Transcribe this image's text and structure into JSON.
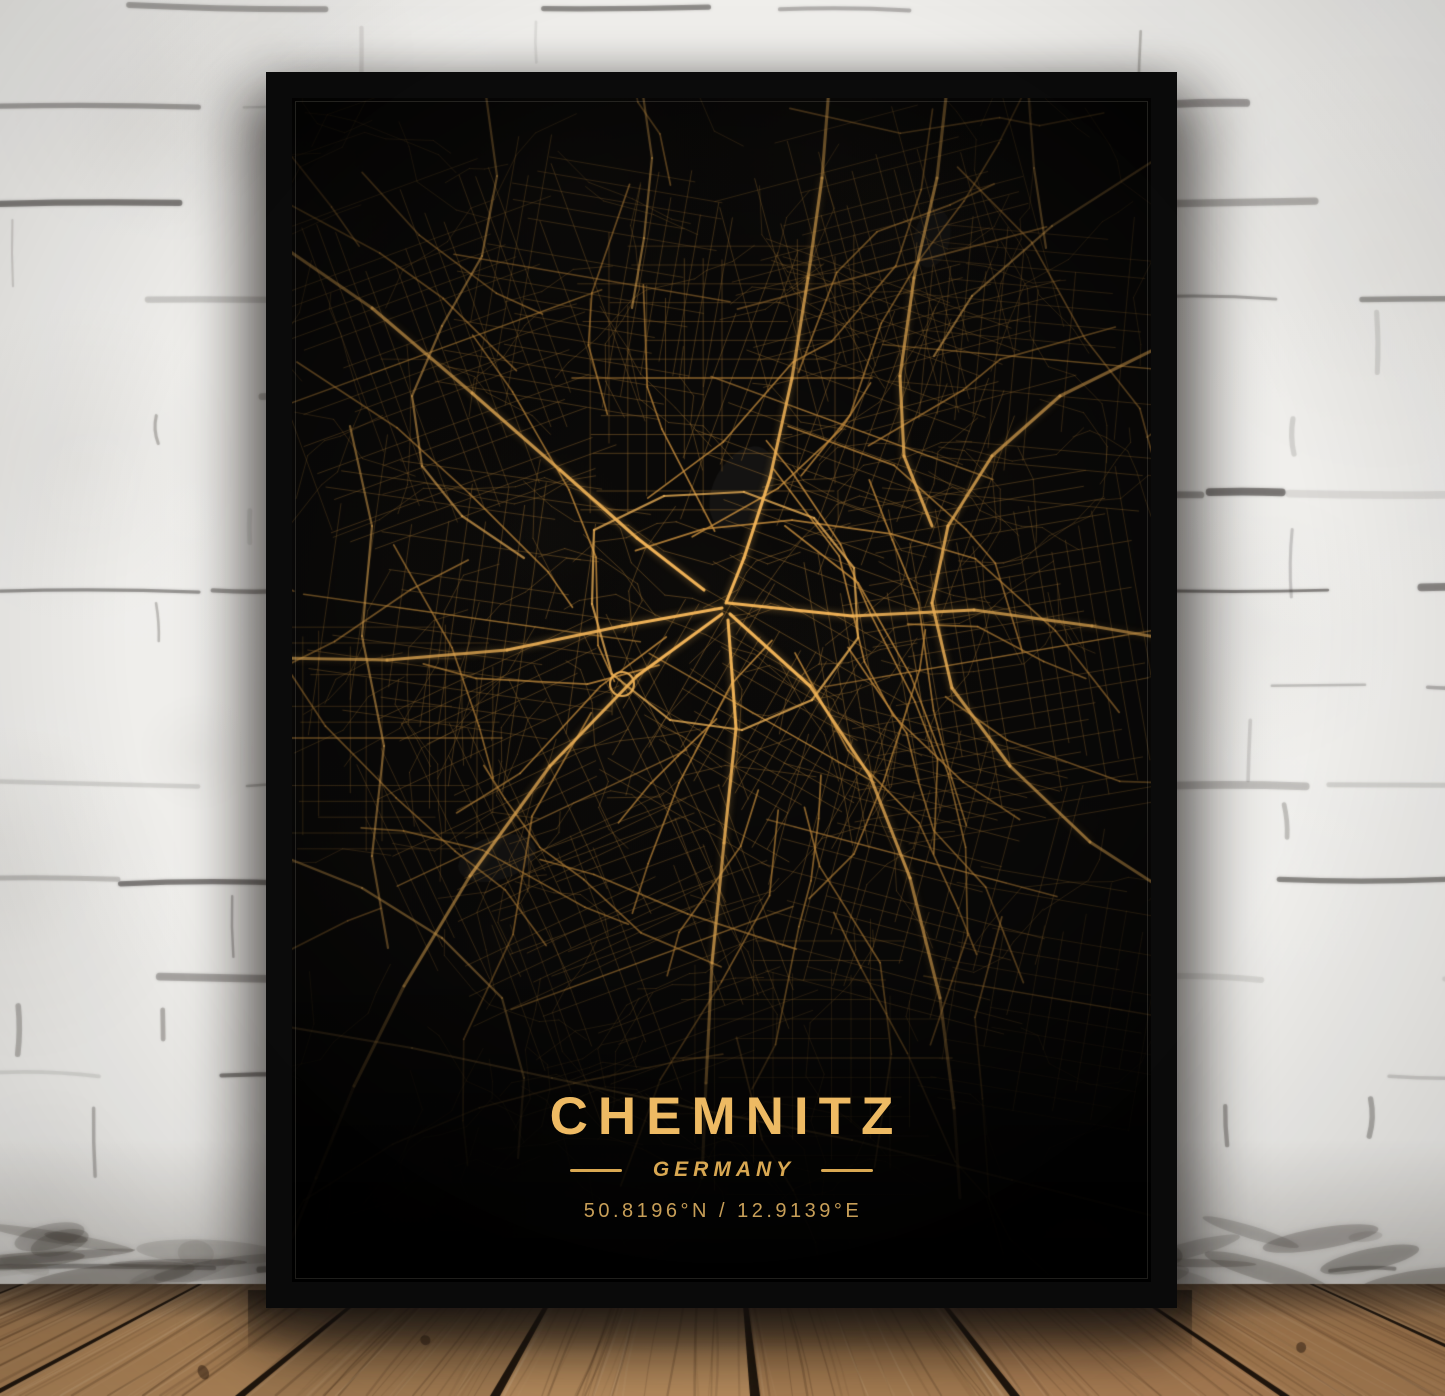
{
  "poster": {
    "title": "CHEMNITZ",
    "country": "GERMANY",
    "coordinates": "50.8196°N / 12.9139°E"
  },
  "style": {
    "gold_title": "#eeba63",
    "gold_subtitle": "#d9a852",
    "gold_coords": "#c89f58",
    "poster_background": "#0a0908",
    "frame_color": "#0b0b0b",
    "road_major": "#f2b458",
    "road_secondary": "#c98f3e",
    "road_minor": "#8a6328",
    "wall_color": "#efeeeb",
    "floor_light": "#b98c5e",
    "floor_dark": "#6f5d4c"
  },
  "map_config": {
    "seed": 12,
    "minor_walks": 175,
    "secondary_roads": 50
  }
}
